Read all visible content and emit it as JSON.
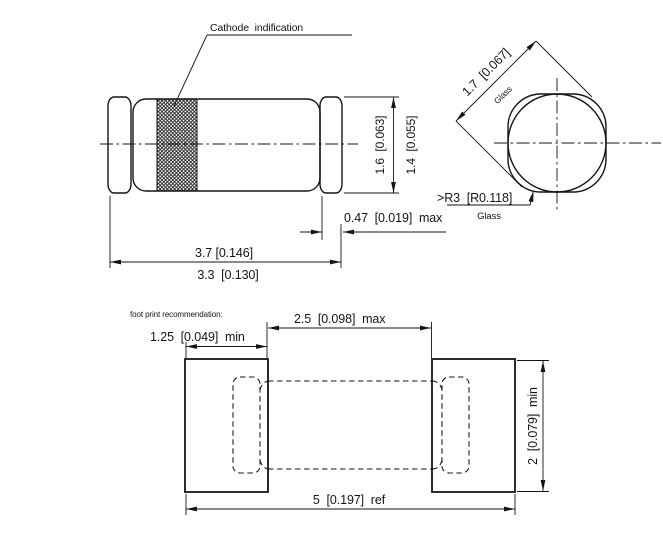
{
  "drawing": {
    "side_view": {
      "cathode_label": "Cathode  indification",
      "dim_cap_diameter": "1.6  [0.063]",
      "dim_glass_diameter": "1.4  [0.055]",
      "dim_cap_width": "0.47  [0.019]  max",
      "dim_length_overall": "3.7 [0.146]",
      "dim_length_body": "3.3  [0.130]"
    },
    "end_view": {
      "dim_diagonal": "1.7  [0.067]",
      "diagonal_note": "Glass",
      "dim_radius": ">R3  [R0.118]",
      "radius_note": "Glass"
    },
    "footprint": {
      "note": "foot print recommendation:",
      "dim_pad_width": "1.25  [0.049]  min",
      "dim_pad_gap": "2.5  [0.098]  max",
      "dim_total_length": "5  [0.197]  ref",
      "dim_pad_height": "2  [0.079]  min"
    }
  }
}
